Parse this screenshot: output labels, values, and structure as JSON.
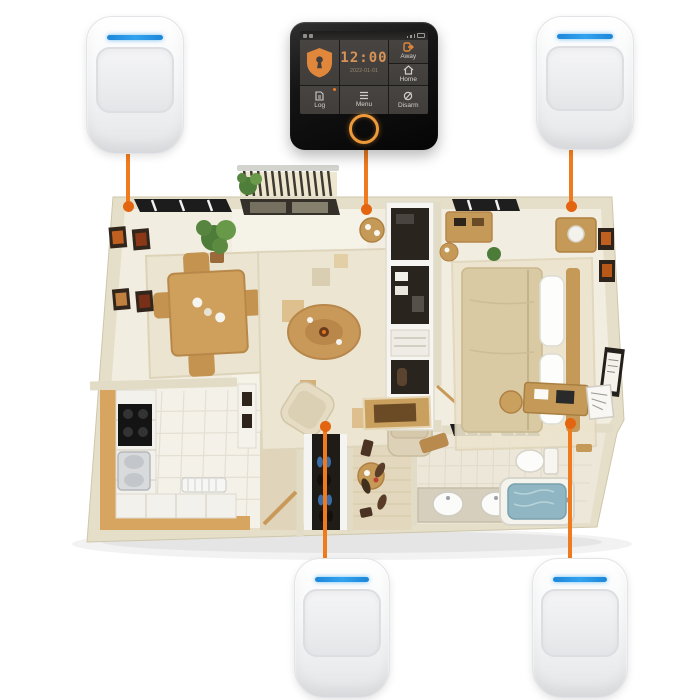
{
  "panel": {
    "device": "touchscreen-alarm-control-panel",
    "status_icons_left": [
      "sim-icon",
      "sd-card-icon"
    ],
    "status_icons_right": [
      "signal-bars-icon",
      "wifi-icon",
      "battery-icon"
    ],
    "clock": {
      "time": "12:00",
      "date": "2022-01-01"
    },
    "buttons": {
      "away": "Away",
      "home": "Home",
      "log": "Log",
      "menu": "Menu",
      "disarm": "Disarm"
    }
  },
  "sensors": [
    {
      "id": "top-left",
      "type": "pir-motion-sensor"
    },
    {
      "id": "top-right",
      "type": "pir-motion-sensor"
    },
    {
      "id": "bottom-center",
      "type": "pir-motion-sensor"
    },
    {
      "id": "bottom-right",
      "type": "pir-motion-sensor"
    }
  ],
  "floor_plan": {
    "rooms": [
      "balcony",
      "dining-room",
      "living-room",
      "bedroom",
      "kitchen",
      "shoe-closet",
      "hall-closet",
      "bathroom"
    ]
  },
  "colors": {
    "accent": "#ef7b1e",
    "accent-dark": "#e4650f",
    "led-blue": "#31a3ef",
    "screen-orange": "#d89358",
    "shield-orange": "#e0873c"
  }
}
